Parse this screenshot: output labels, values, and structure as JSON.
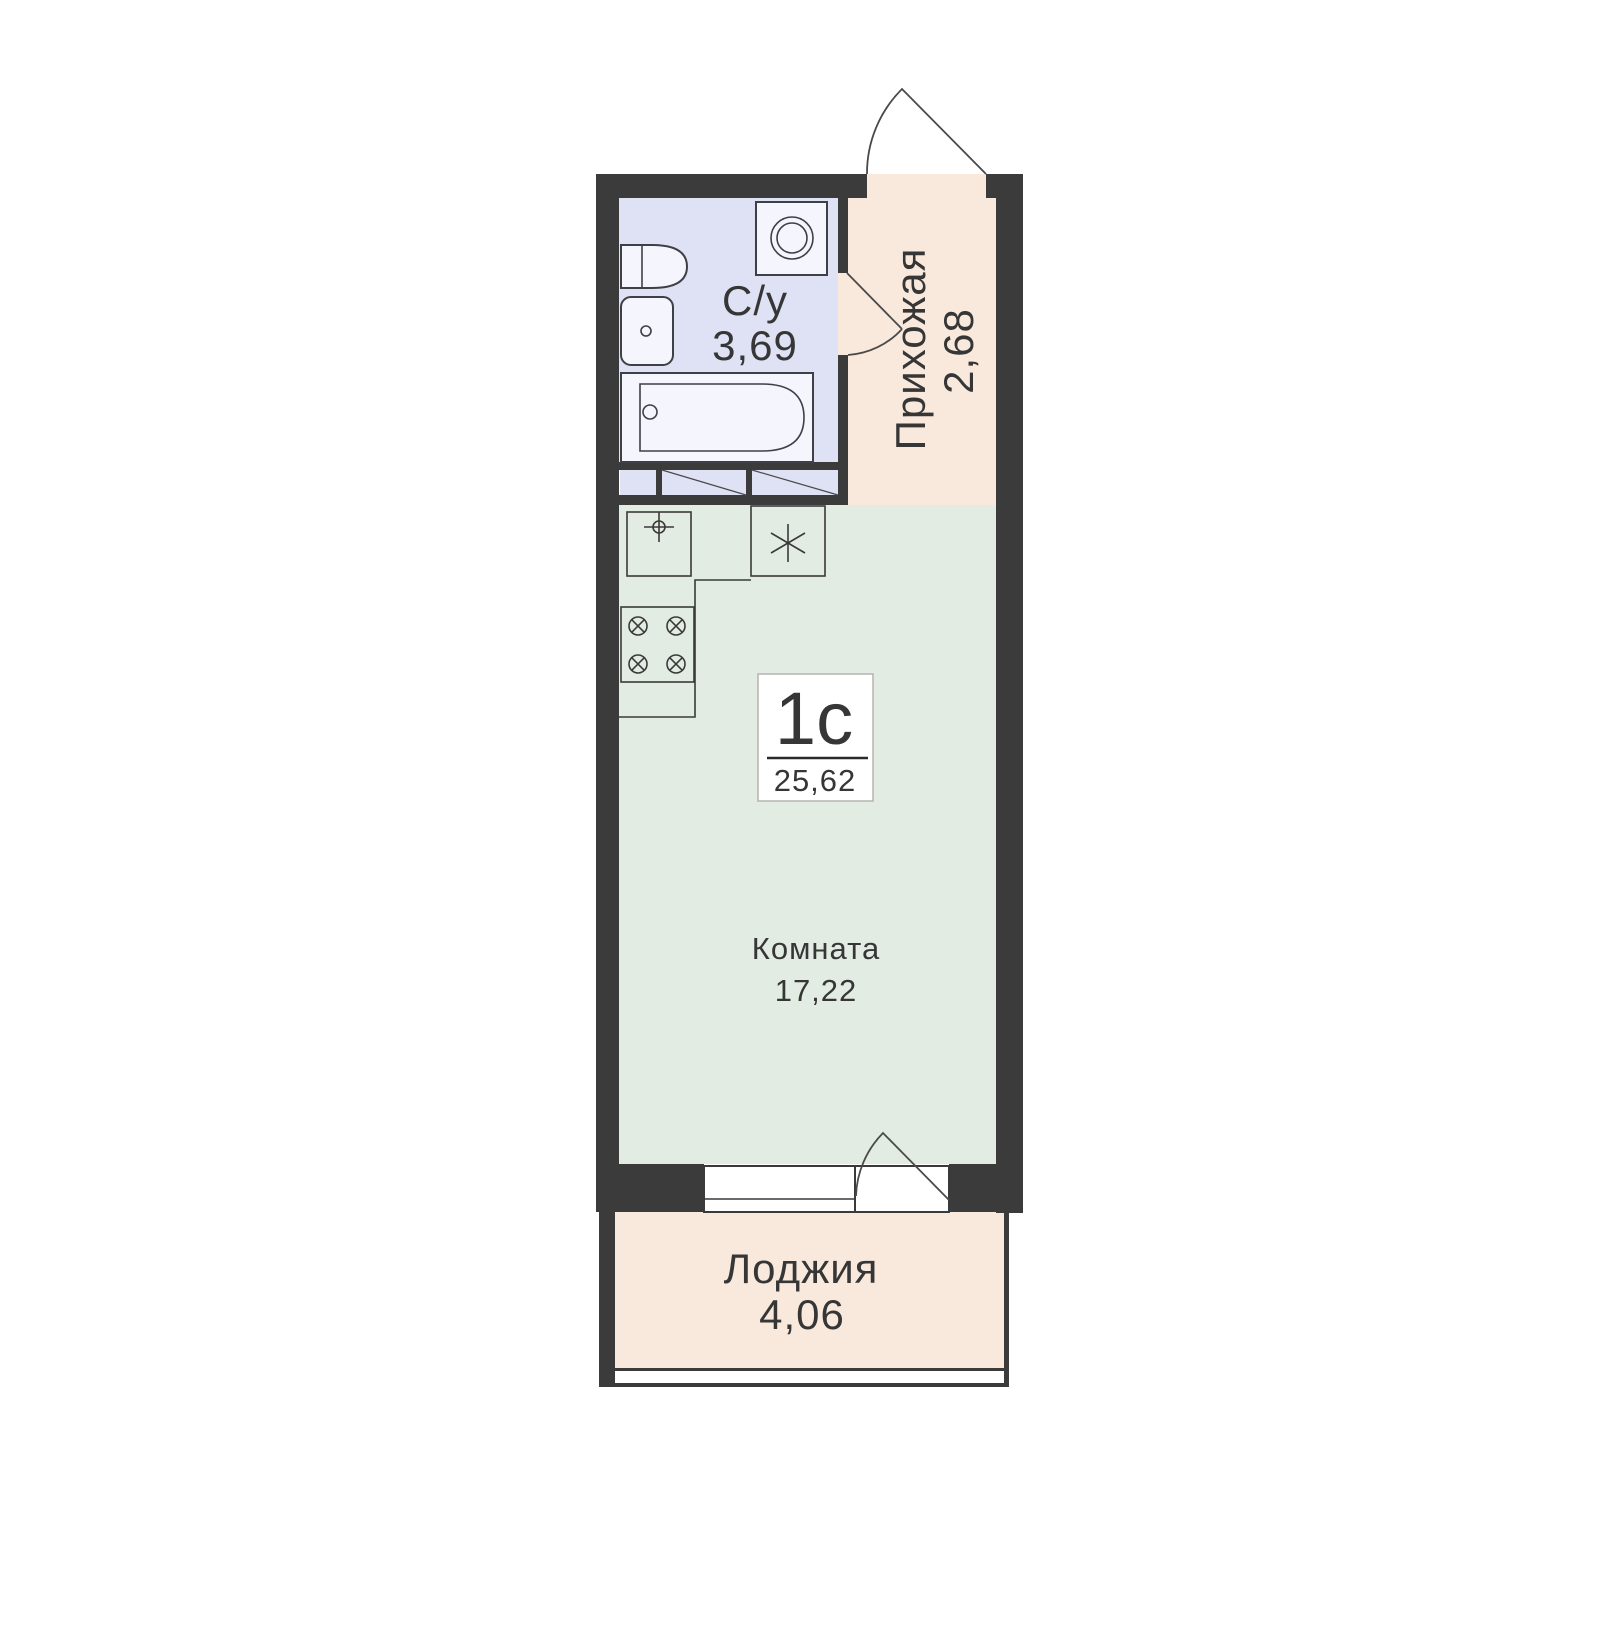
{
  "unit": {
    "type_label": "1с",
    "total_area": "25,62"
  },
  "rooms": {
    "bathroom": {
      "name": "С/у",
      "area": "3,69"
    },
    "hallway": {
      "name": "Прихожая",
      "area": "2,68"
    },
    "room": {
      "name": "Комната",
      "area": "17,22"
    },
    "loggia": {
      "name": "Лоджия",
      "area": "4,06"
    }
  },
  "icons": {
    "washing_machine": "washing-machine-icon",
    "toilet": "toilet-icon",
    "sink": "sink-icon",
    "bathtub": "bathtub-icon",
    "kitchen_sink": "kitchen-sink-icon",
    "fridge": "fridge-snowflake-icon",
    "stove": "stove-burners-icon"
  },
  "colors": {
    "wall": "#3b3b3b",
    "bathroom_floor": "#dfe2f5",
    "hallway_floor": "#f8e9dc",
    "room_floor": "#e3ece2",
    "loggia_floor": "#f8e9dc",
    "label_box_border": "#b3b3b3",
    "text": "#363636"
  }
}
